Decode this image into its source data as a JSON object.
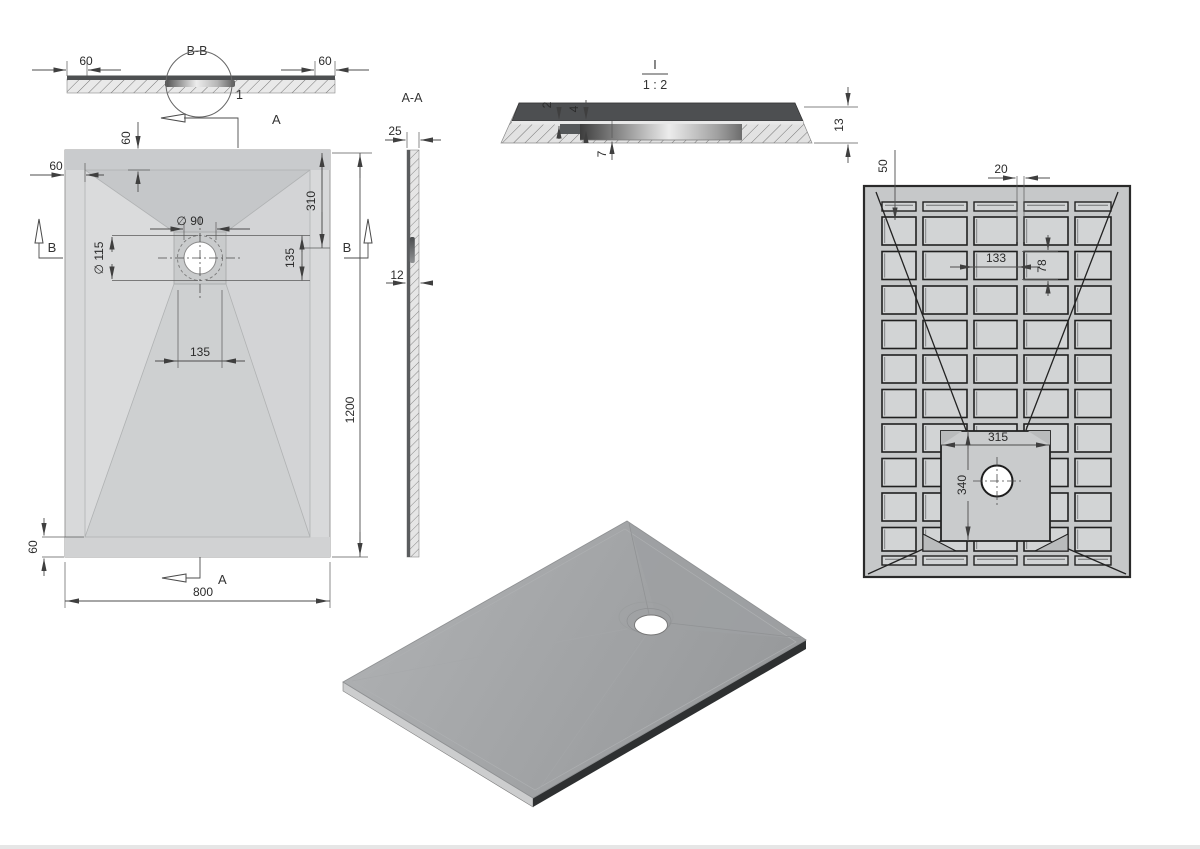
{
  "bb": {
    "title": "B-B",
    "callout": "1",
    "dim_left": "60",
    "dim_right": "60",
    "marker_a": "A"
  },
  "plan": {
    "a_bottom": "A",
    "b_left": "B",
    "b_right": "B",
    "dia90": "∅ 90",
    "dia115": "∅ 115",
    "d60_top": "60",
    "d60_left": "60",
    "d60_bottom": "60",
    "d310": "310",
    "d135_right": "135",
    "d135_below": "135",
    "d800": "800",
    "d1200": "1200"
  },
  "aa": {
    "title": "A-A",
    "dim_top": "25",
    "dim_bottom": "12"
  },
  "detail": {
    "title": "I",
    "scale": "1 : 2",
    "d2": "2",
    "d4": "4",
    "d7": "7",
    "d13": "13"
  },
  "bottom": {
    "d50": "50",
    "d20": "20",
    "d133": "133",
    "d78": "78",
    "d315": "315",
    "d340": "340"
  }
}
